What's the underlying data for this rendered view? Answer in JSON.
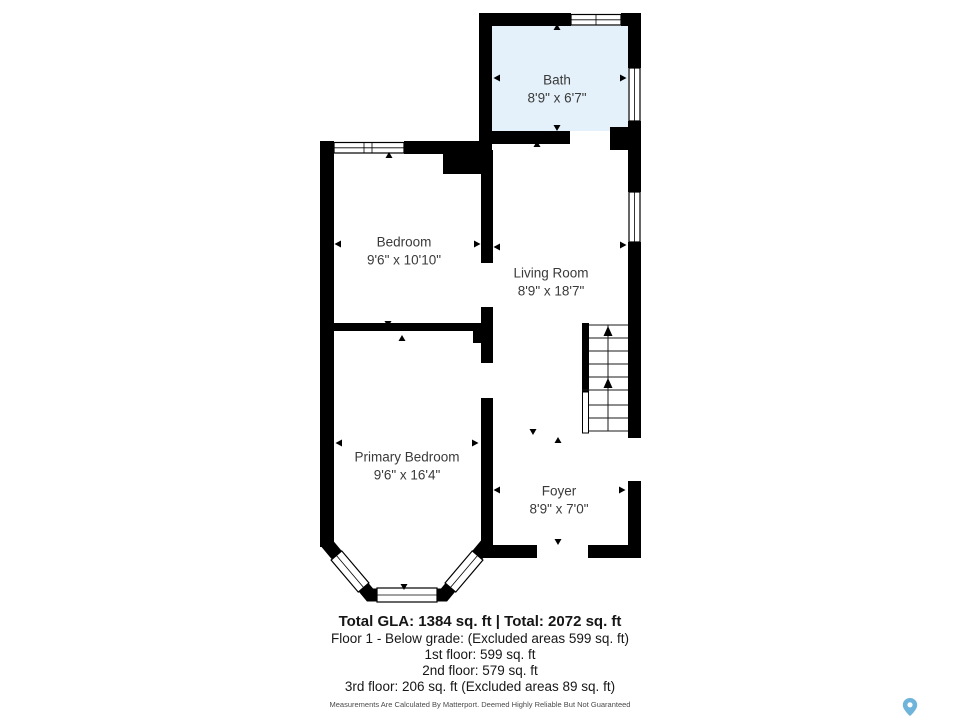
{
  "plan": {
    "wall_color": "#000000",
    "bath_fill": "#e4f1fa",
    "label_color": "#3a3a3a"
  },
  "rooms": [
    {
      "id": "bath",
      "name": "Bath",
      "dims": "8'9\" x 6'7\""
    },
    {
      "id": "bedroom",
      "name": "Bedroom",
      "dims": "9'6\" x 10'10\""
    },
    {
      "id": "living-room",
      "name": "Living Room",
      "dims": "8'9\" x 18'7\""
    },
    {
      "id": "primary-bedroom",
      "name": "Primary Bedroom",
      "dims": "9'6\" x 16'4\""
    },
    {
      "id": "foyer",
      "name": "Foyer",
      "dims": "8'9\" x 7'0\""
    }
  ],
  "summary": {
    "total": "Total GLA: 1384 sq. ft | Total: 2072 sq. ft",
    "lines": [
      "Floor 1 - Below grade: (Excluded areas 599 sq. ft)",
      "1st floor: 599 sq. ft",
      "2nd floor: 579 sq. ft",
      "3rd floor: 206 sq. ft (Excluded areas 89 sq. ft)"
    ],
    "disclaimer": "Measurements Are Calculated By Matterport. Deemed Highly Reliable But Not Guaranteed"
  },
  "branding": {
    "logo": "matterport-pin",
    "pin_color": "#6fb4da"
  }
}
